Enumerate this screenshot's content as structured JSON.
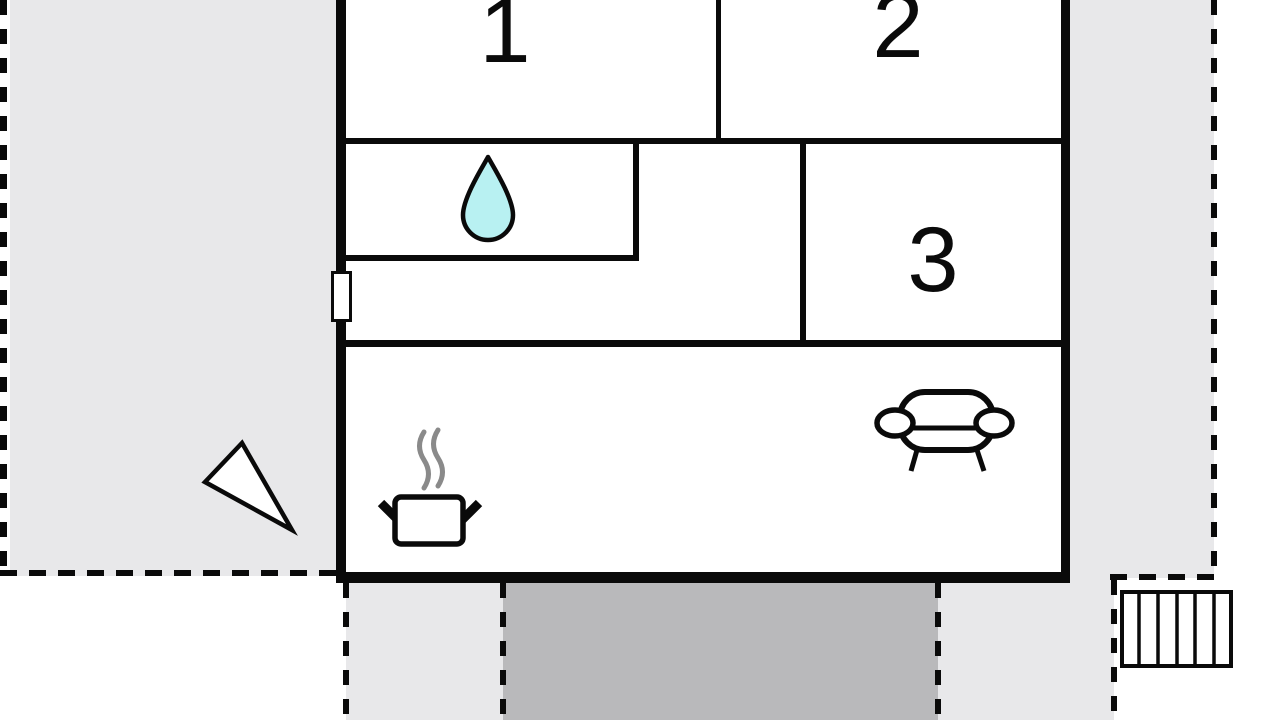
{
  "plan": {
    "title": "apartment-floor-plan",
    "rooms": [
      {
        "id": "room-1",
        "label": "1"
      },
      {
        "id": "room-2",
        "label": "2"
      },
      {
        "id": "room-3",
        "label": "3"
      }
    ],
    "icons": {
      "bathroom": "water-drop-icon",
      "kitchen": "cooking-pot-steam-icon",
      "living_room": "sofa-icon",
      "outdoor_stairs": "stairs-icon",
      "terrace_marker": "direction-triangle-icon",
      "left_wall_opening": "window-marker"
    },
    "colors": {
      "terrace_light_gray": "#e8e8ea",
      "driveway_dark_gray": "#b9b9bb",
      "water_drop_fill": "#b8f1f2",
      "steam_gray": "#8a8a8a",
      "wall_black": "#0a0a0a",
      "floor_white": "#ffffff"
    }
  }
}
